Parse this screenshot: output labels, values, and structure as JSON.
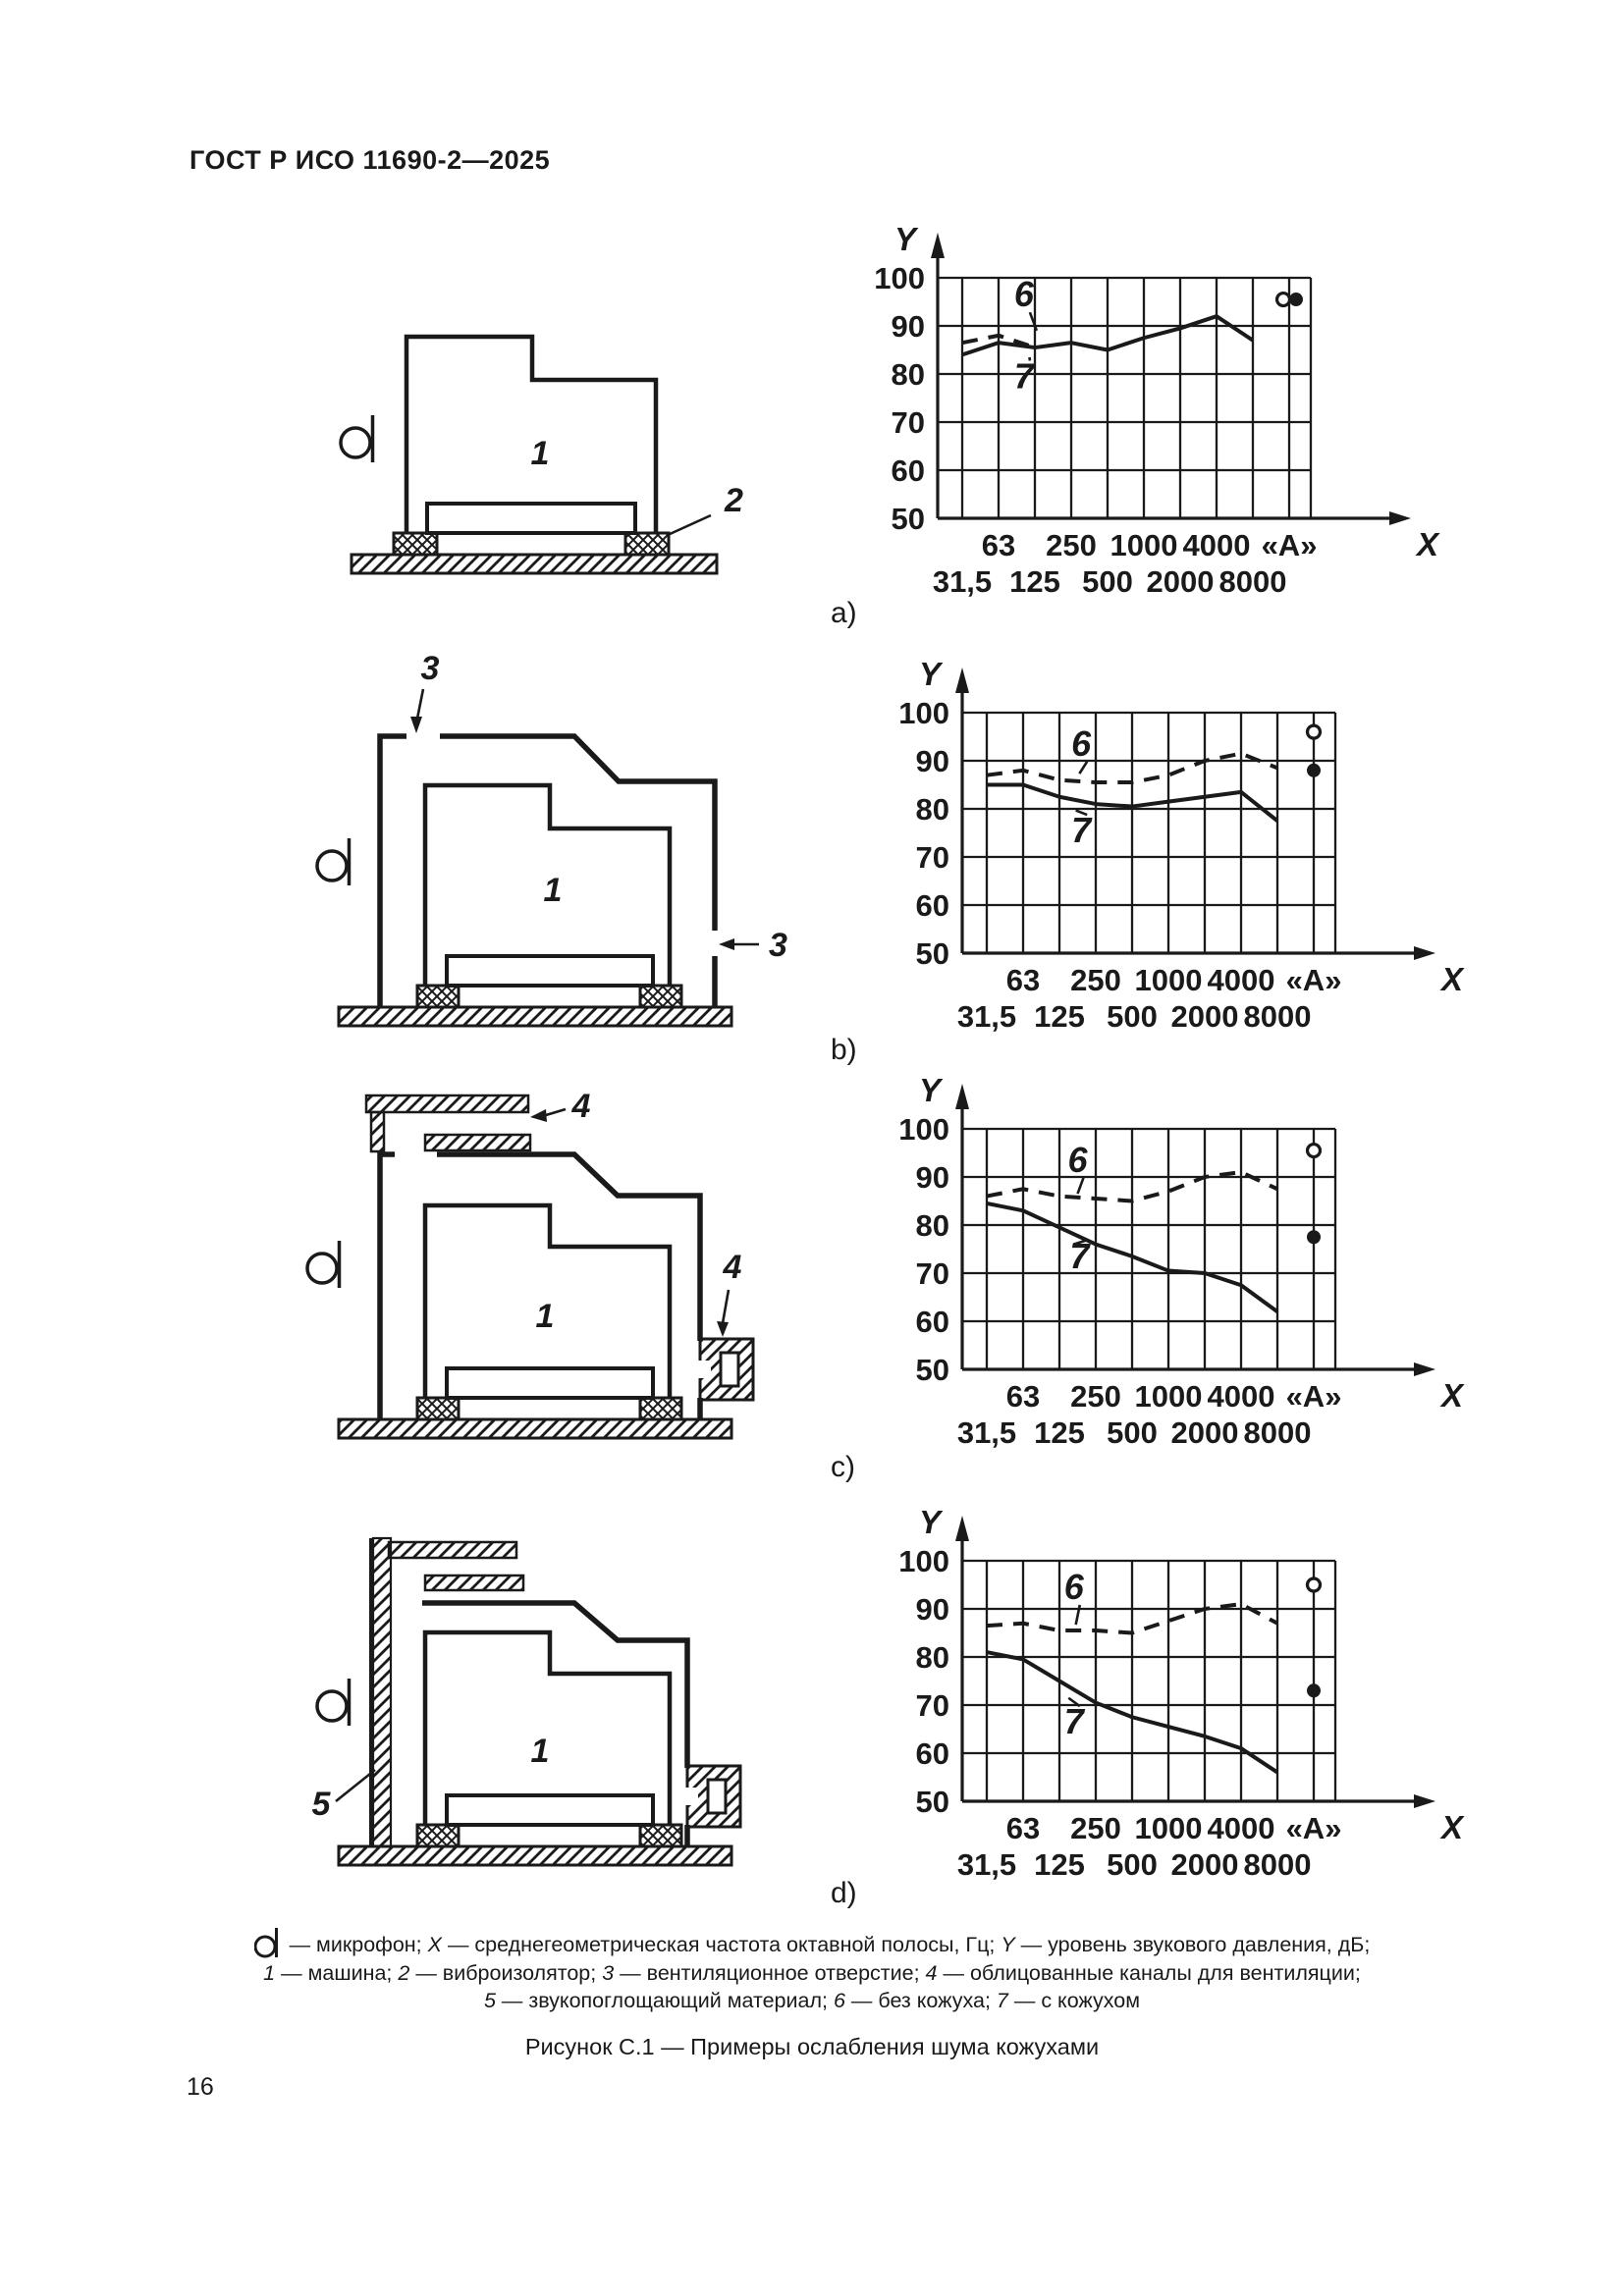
{
  "page": {
    "header": "ГОСТ Р ИСО 11690-2—2025",
    "page_number": "16",
    "figure_title": "Рисунок С.1 — Примеры ослабления шума кожухами",
    "panel_labels": [
      "a)",
      "b)",
      "c)",
      "d)"
    ]
  },
  "diagram_labels": {
    "machine": "1",
    "isolator": "2",
    "vent": "3",
    "duct": "4",
    "absorber": "5"
  },
  "caption_lines": [
    [
      {
        "t": "",
        "sym": true
      },
      {
        "t": " — микрофон; "
      },
      {
        "t": "X",
        "i": true
      },
      {
        "t": " — среднегеометрическая частота октавной полосы, Гц; "
      },
      {
        "t": "Y",
        "i": true
      },
      {
        "t": " — уровень звукового давления, дБ;"
      }
    ],
    [
      {
        "t": "1",
        "i": true
      },
      {
        "t": " — машина; "
      },
      {
        "t": "2",
        "i": true
      },
      {
        "t": " — виброизолятор; "
      },
      {
        "t": "3",
        "i": true
      },
      {
        "t": " — вентиляционное отверстие; "
      },
      {
        "t": "4",
        "i": true
      },
      {
        "t": " — облицованные каналы для вентиляции;"
      }
    ],
    [
      {
        "t": "5",
        "i": true
      },
      {
        "t": " — звукопоглощающий материал; "
      },
      {
        "t": "6",
        "i": true
      },
      {
        "t": " — без кожуха; "
      },
      {
        "t": "7",
        "i": true
      },
      {
        "t": " — с кожухом"
      }
    ]
  ],
  "chart_axis": {
    "y_title": "Y",
    "x_title": "X",
    "y_ticks": [
      "100",
      "90",
      "80",
      "70",
      "60",
      "50"
    ],
    "ylim": [
      50,
      100
    ],
    "x_row1": [
      "63",
      "250",
      "1000",
      "4000",
      "«А»"
    ],
    "x_row2": [
      "31,5",
      "125",
      "500",
      "2000",
      "8000"
    ],
    "bands": [
      "31,5",
      "63",
      "125",
      "250",
      "500",
      "1000",
      "2000",
      "4000",
      "8000"
    ],
    "x_meaning": "среднегеометрическая частота октавной полосы, Гц",
    "y_meaning": "уровень звукового давления, дБ"
  },
  "chart_data": [
    {
      "panel": "a",
      "type": "line",
      "series": [
        {
          "name": "6",
          "legend": "без кожуха",
          "style": "dashed",
          "values": [
            86.5,
            88,
            85.5,
            null,
            null,
            null,
            null,
            null,
            null
          ]
        },
        {
          "name": "7",
          "legend": "с кожухом",
          "style": "solid",
          "values": [
            84,
            86.5,
            85.5,
            86.5,
            85,
            87.5,
            89.5,
            92,
            87
          ]
        }
      ],
      "a_weighted": {
        "open_circle": 95.5,
        "filled_circle": 95.5
      },
      "callouts": {
        "6": {
          "u": 1.7,
          "v": 96.5,
          "tu": 2.05,
          "tv": 88
        },
        "7": {
          "u": 1.7,
          "v": 79.5,
          "tu": 1.85,
          "tv": 84.5
        }
      }
    },
    {
      "panel": "b",
      "type": "line",
      "series": [
        {
          "name": "6",
          "legend": "без кожуха",
          "style": "dashed",
          "values": [
            87,
            88,
            86,
            85.5,
            85.5,
            87,
            90,
            91.5,
            88.5
          ]
        },
        {
          "name": "7",
          "legend": "с кожухом",
          "style": "solid",
          "values": [
            85,
            85,
            82.5,
            81,
            80.5,
            81.5,
            82.5,
            83.5,
            77.5
          ]
        }
      ],
      "a_weighted": {
        "open_circle": 96,
        "filled_circle": 88
      },
      "callouts": {
        "6": {
          "u": 2.6,
          "v": 93.5,
          "tu": 2.55,
          "tv": 86.3
        },
        "7": {
          "u": 2.6,
          "v": 75.5,
          "tu": 2.45,
          "tv": 80.7
        }
      }
    },
    {
      "panel": "c",
      "type": "line",
      "series": [
        {
          "name": "6",
          "legend": "без кожуха",
          "style": "dashed",
          "values": [
            86,
            87.5,
            86,
            85.5,
            85,
            87,
            90,
            91,
            87.5
          ]
        },
        {
          "name": "7",
          "legend": "с кожухом",
          "style": "solid",
          "values": [
            84.5,
            83,
            79.5,
            76,
            73.5,
            70.5,
            70,
            67.5,
            62
          ]
        }
      ],
      "a_weighted": {
        "open_circle": 95.5,
        "filled_circle": 77.5
      },
      "callouts": {
        "6": {
          "u": 2.5,
          "v": 93.5,
          "tu": 2.5,
          "tv": 85.5
        },
        "7": {
          "u": 2.55,
          "v": 73.5,
          "tu": 2.38,
          "tv": 77
        }
      }
    },
    {
      "panel": "d",
      "type": "line",
      "series": [
        {
          "name": "6",
          "legend": "без кожуха",
          "style": "dashed",
          "values": [
            86.5,
            87,
            85.5,
            85.5,
            85,
            87.5,
            90,
            91,
            87
          ]
        },
        {
          "name": "7",
          "legend": "с кожухом",
          "style": "solid",
          "values": [
            81,
            79.5,
            75,
            70.5,
            67.5,
            65.5,
            63.5,
            61,
            56
          ]
        }
      ],
      "a_weighted": {
        "open_circle": 95,
        "filled_circle": 73
      },
      "callouts": {
        "6": {
          "u": 2.4,
          "v": 94.5,
          "tu": 2.45,
          "tv": 85.7
        },
        "7": {
          "u": 2.4,
          "v": 66.5,
          "tu": 2.25,
          "tv": 72.5
        }
      }
    }
  ]
}
